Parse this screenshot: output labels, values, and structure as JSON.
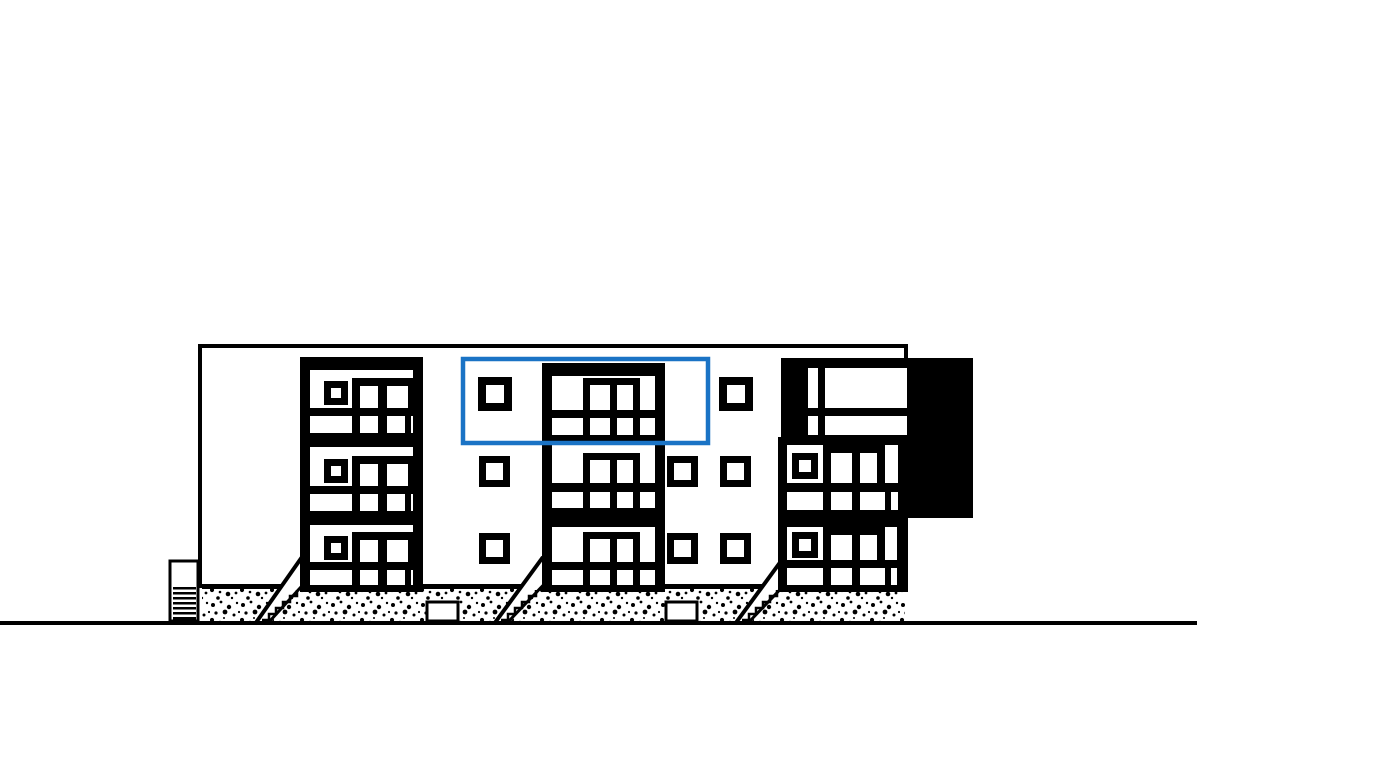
{
  "page": {
    "kind": "architectural-elevation-drawing",
    "description": "Black and white street elevation of a 3-storey apartment building with three window bays, entrance stairs, stippled foundation band, a solid black corner panel at the upper right, and a blue rectangle highlighting the top-floor centre bay."
  },
  "colors": {
    "line": "#000000",
    "background": "#ffffff",
    "panel": "#000000",
    "highlight": "#1a73c5"
  },
  "building": {
    "floors": 3,
    "bays": [
      "left-bay",
      "center-bay",
      "right-bay"
    ],
    "entrance_stairs": 3,
    "basement_lightwells": 2,
    "has_cellar_vent_grate": true,
    "dark_corner_panel": true
  },
  "annotations": {
    "highlight_box": {
      "x": 463,
      "y": 359,
      "width": 245,
      "height": 84,
      "stroke_width": 4.5,
      "color": "#1a73c5",
      "marks": "top-floor-center-bay"
    }
  },
  "ground": {
    "baseline_y": 621,
    "baseline_length": 1197
  }
}
